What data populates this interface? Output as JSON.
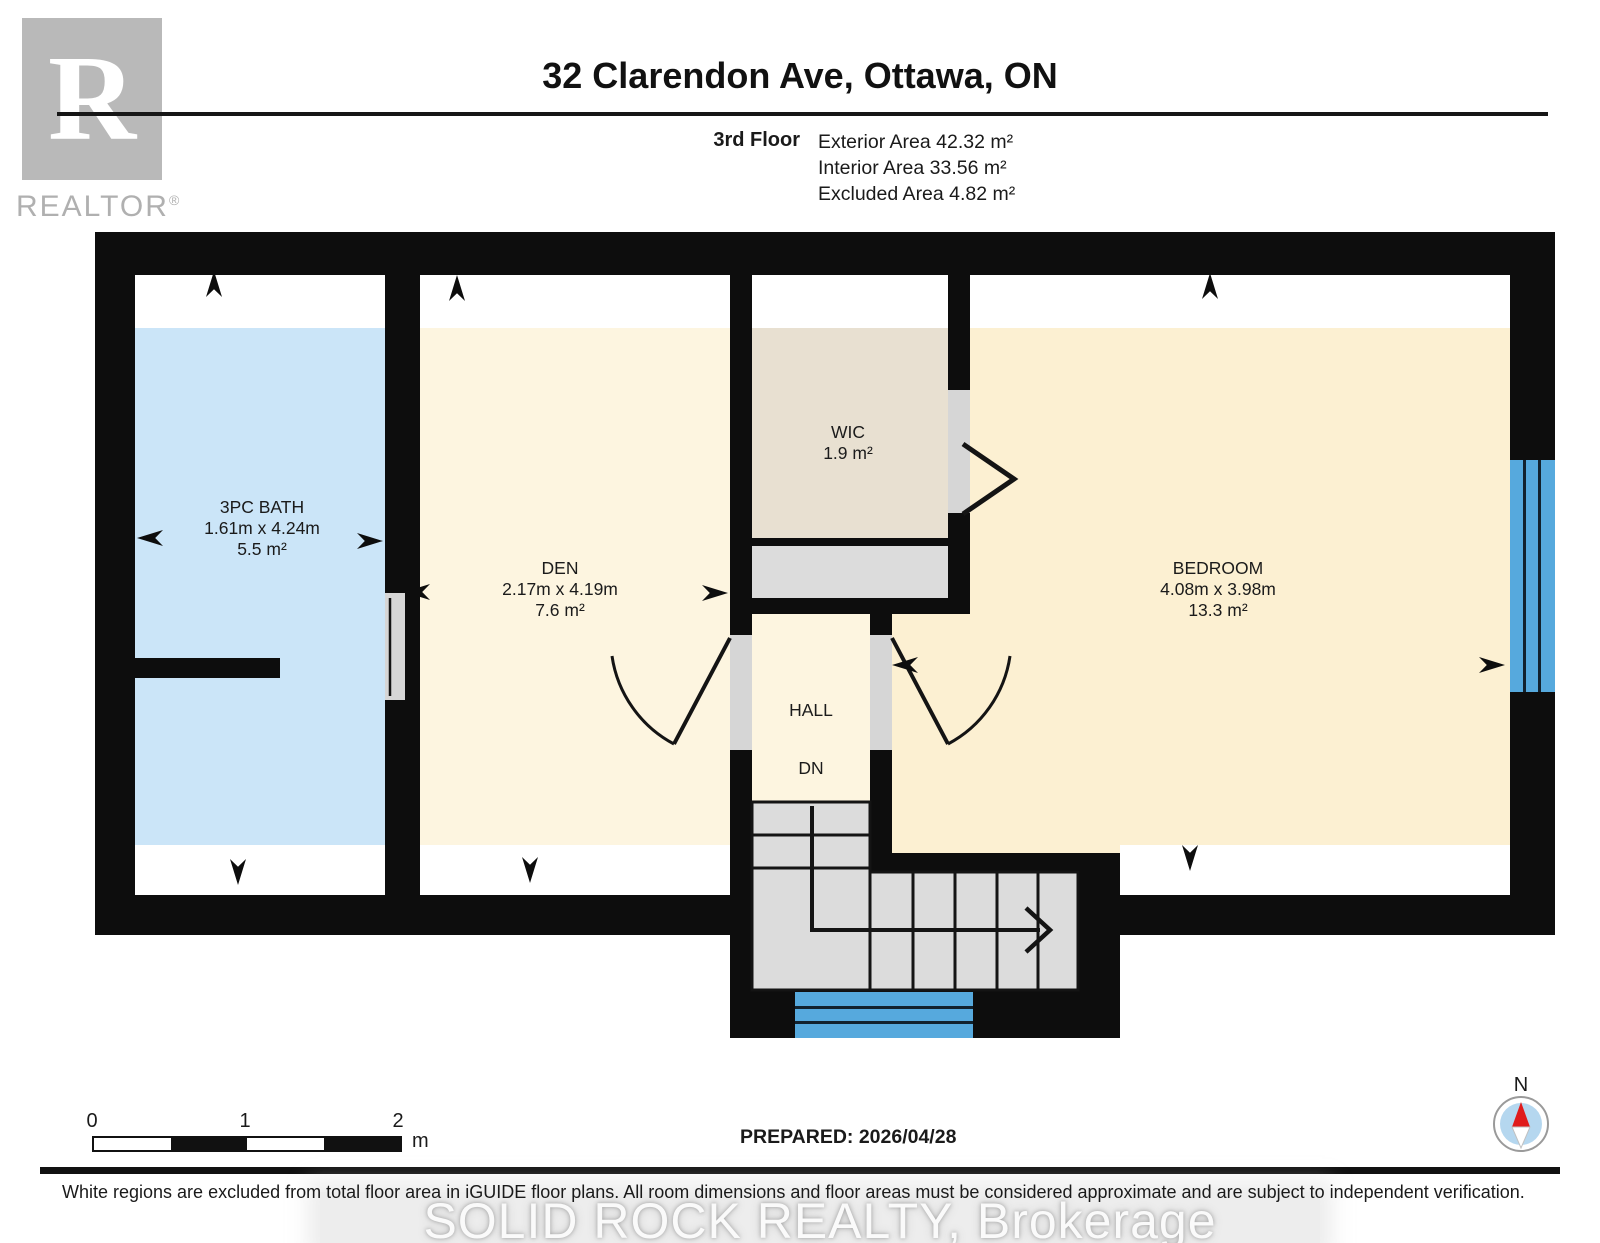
{
  "header": {
    "logo_letter": "R",
    "logo_brand": "REALTOR",
    "logo_reg": "®",
    "title": "32 Clarendon Ave, Ottawa, ON",
    "floor_label": "3rd Floor",
    "area_lines": [
      "Exterior Area 42.32 m²",
      "Interior Area 33.56 m²",
      "Excluded Area 4.82 m²"
    ]
  },
  "rooms": {
    "bath": {
      "name": "3PC BATH",
      "dims": "1.61m x 4.24m",
      "area": "5.5 m²"
    },
    "den": {
      "name": "DEN",
      "dims": "2.17m x 4.19m",
      "area": "7.6 m²"
    },
    "wic": {
      "name": "WIC",
      "area": "1.9 m²"
    },
    "bedroom": {
      "name": "BEDROOM",
      "dims": "4.08m x 3.98m",
      "area": "13.3 m²"
    },
    "hall": {
      "name": "HALL"
    },
    "stairs": {
      "direction_label": "DN"
    }
  },
  "footer": {
    "scale_bar": {
      "tick_0": "0",
      "tick_1": "1",
      "tick_2": "2",
      "unit": "m"
    },
    "prepared": "PREPARED: 2026/04/28",
    "compass": {
      "north_label": "N"
    },
    "disclaimer": "White regions are excluded from total floor area in iGUIDE floor plans. All room dimensions and floor areas must be considered approximate and are subject to independent verification.",
    "watermark": "SOLID ROCK REALTY, Brokerage"
  },
  "colors": {
    "wall": "#0d0d0d",
    "bath_fill": "#cbe5f8",
    "room_fill": "#fdf5e0",
    "bedroom_fill": "#fcf0d2",
    "wic_fill": "#e8e0d1",
    "stairs_fill": "#dcdcdc",
    "window_blue": "#56a9dd",
    "excluded_white": "#ffffff"
  }
}
